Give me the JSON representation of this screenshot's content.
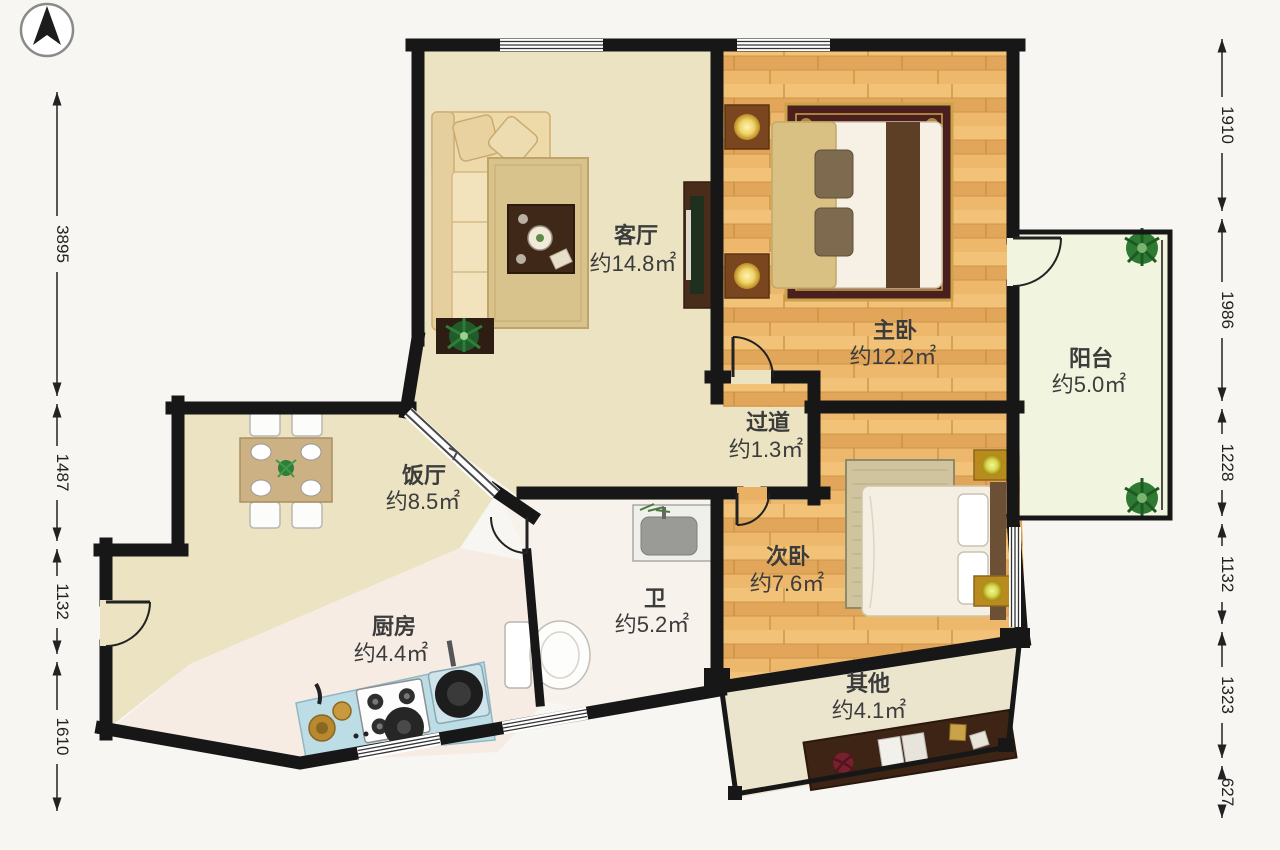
{
  "plan": {
    "title": "apartment-floor-plan",
    "rooms": [
      {
        "key": "living",
        "name": "客厅",
        "area": "约14.8㎡"
      },
      {
        "key": "master",
        "name": "主卧",
        "area": "约12.2㎡"
      },
      {
        "key": "balcony",
        "name": "阳台",
        "area": "约5.0㎡"
      },
      {
        "key": "hall",
        "name": "过道",
        "area": "约1.3㎡"
      },
      {
        "key": "dining",
        "name": "饭厅",
        "area": "约8.5㎡"
      },
      {
        "key": "second",
        "name": "次卧",
        "area": "约7.6㎡"
      },
      {
        "key": "bath",
        "name": "卫",
        "area": "约5.2㎡"
      },
      {
        "key": "kitchen",
        "name": "厨房",
        "area": "约4.4㎡"
      },
      {
        "key": "other",
        "name": "其他",
        "area": "约4.1㎡"
      }
    ],
    "dimensions_left": [
      {
        "value": "3895"
      },
      {
        "value": "1487"
      },
      {
        "value": "1132"
      },
      {
        "value": "1610"
      }
    ],
    "dimensions_right": [
      {
        "value": "1910"
      },
      {
        "value": "1986"
      },
      {
        "value": "1228"
      },
      {
        "value": "1132"
      },
      {
        "value": "1323"
      },
      {
        "value": "627"
      }
    ],
    "colors": {
      "wall": "#171717",
      "floor_main": "#ebe3c1",
      "floor_wood": "#eab164",
      "floor_wet": "#f6ece4",
      "floor_bath": "#f8f2ec",
      "floor_balcony": "#f1f4de",
      "floor_other": "#ece5ce",
      "kitchen_counter": "#bcdde5",
      "label_text": "#3c3c3c"
    }
  }
}
